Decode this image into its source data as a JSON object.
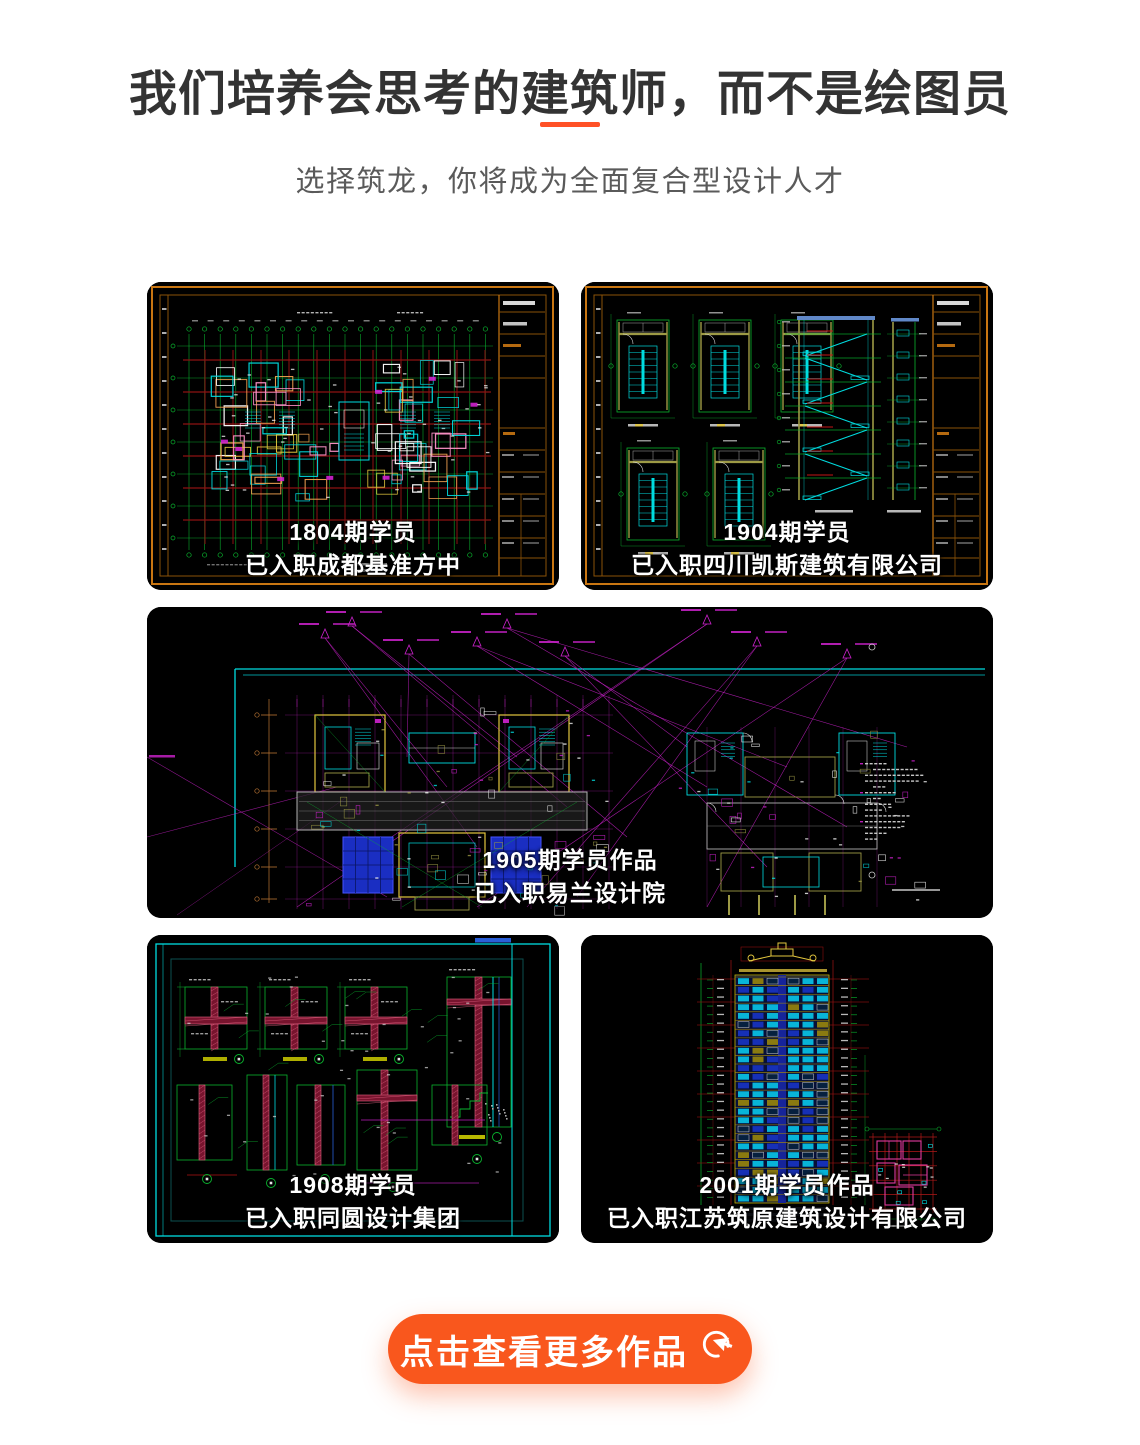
{
  "header": {
    "title": "我们培养会思考的建筑师，而不是绘图员",
    "subtitle": "选择筑龙，你将成为全面复合型设计人才",
    "divider_color": "#ff5126"
  },
  "cards": [
    {
      "id": "work-1804",
      "type": "floor-plan",
      "line1": "1804期学员",
      "line2": "已入职成都基准方中"
    },
    {
      "id": "work-1904",
      "type": "stair-details",
      "line1": "1904期学员",
      "line2": "已入职四川凯斯建筑有限公司"
    },
    {
      "id": "work-1905",
      "type": "unit-plans",
      "line1": "1905期学员作品",
      "line2": "已入职易兰设计院"
    },
    {
      "id": "work-1908",
      "type": "wall-details",
      "line1": "1908期学员",
      "line2": "已入职同圆设计集团"
    },
    {
      "id": "work-2001",
      "type": "tower-elevation",
      "line1": "2001期学员作品",
      "line2": "已入职江苏筑原建筑设计有限公司"
    }
  ],
  "cta": {
    "label": "点击查看更多作品",
    "icon": "click-cursor-icon",
    "color": "#f9571d"
  },
  "palette": {
    "sheet_frame_orange": "#c97612",
    "sheet_frame_orange_dim": "#8a5208",
    "grid_green": "#09b42e",
    "structural_dark_red": "#8c1212",
    "accent_red": "#c41616",
    "cad_cyan": "#00dce0",
    "cad_blue_fill": "#1a2ec2",
    "steel_blue": "#6088c8",
    "magenta": "#cf22cf",
    "pink_wall": "#ff93c8",
    "orange_wall": "#f0a050",
    "hatch_pink": "#e06080",
    "hatch_dark_red": "#78142e",
    "yellow": "#e2c63e",
    "khaki": "#9d9a45",
    "white_ink": "#e8e8e8"
  }
}
